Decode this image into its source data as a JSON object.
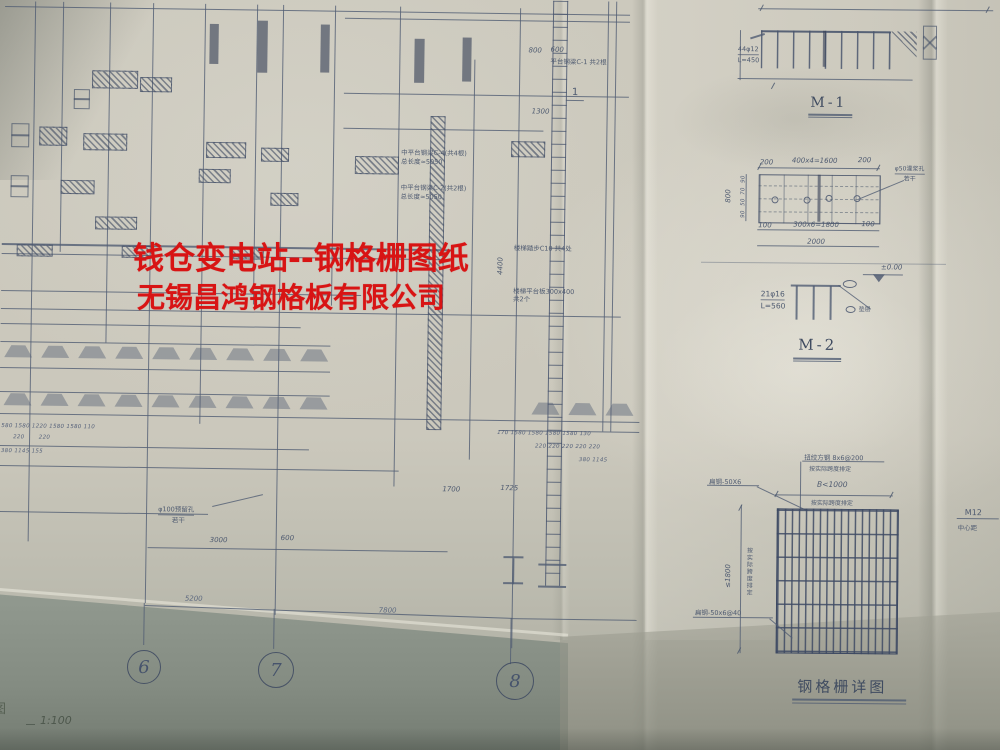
{
  "watermark": {
    "line1": "钱仓变电站--钢格栅图纸",
    "line2": "无锡昌鸿钢格板有限公司"
  },
  "plan": {
    "scale_prefix": "图",
    "scale_label": "1:100",
    "axis_bubbles": [
      "6",
      "7",
      "8"
    ],
    "axis_dim_67": "5200",
    "axis_dim_78": "7800",
    "dims": {
      "top_800": "800",
      "top_600": "600",
      "v_1300": "1300",
      "v_4400": "4400",
      "d_1700": "1700",
      "d_1725": "1725",
      "d_3000": "3000",
      "d_600": "600"
    },
    "dim_chains": {
      "left_row1": "580 1580 1220 1580 1580 110",
      "left_row2": "220       220",
      "left_row3": "380 1145 155",
      "right_row1": "170 1580 1580 1580 1580 130",
      "right_row2": "220 220 220 220 220",
      "right_row3": "380 1145"
    },
    "annotations": {
      "beam_c1": "平台钢梁C-1 共2根",
      "beam_c4_1": "中平台钢梁C-4(共4根)",
      "beam_c4_2": "总长度≈5050",
      "beam_c2_1": "中平台钢梁C-2(共2根)",
      "beam_c2_2": "总长度≈5050",
      "stair_tread": "楼梯踏步C10 共4处",
      "stair_platform": "楼梯平台板300x400 共2个",
      "hole100_1": "φ100预留孔",
      "hole100_2": "若干",
      "section_mark": "1"
    }
  },
  "details": {
    "m1": {
      "title": "M-1",
      "rebar": "44φ12",
      "length": "L=450"
    },
    "m2": {
      "title": "M-2",
      "rebar": "21φ16",
      "length": "L=560",
      "level": "±0.00",
      "pad_note": "垫层",
      "top_dims": [
        "200",
        "400x4=1600",
        "200"
      ],
      "bottom_dims": [
        "100",
        "300x6=1800",
        "100"
      ],
      "total_dim": "2000",
      "left_total": "800",
      "left_segs": [
        "90",
        "70",
        "50",
        "90"
      ],
      "hole_callout_1": "φ50灌浆孔",
      "hole_callout_2": "若干"
    },
    "grating": {
      "caption": "钢格栅详图",
      "crossbar_label": "扭绞方钢 8x6@200",
      "crossbar_note": "按实际跨度排定",
      "width_label": "B<1000",
      "width_note": "按实际跨度排定",
      "flat_callout": "扁钢-50X6",
      "height_label": "≤1800",
      "height_note": "按实际跨度排定",
      "bottom_callout": "扁钢-50x6@40"
    },
    "right_edge": {
      "bolt": "M12",
      "note": "中心距"
    }
  },
  "colors": {
    "watermark_red": "#d81414",
    "ink": "#57637a",
    "paper": "#ccc9bd"
  }
}
